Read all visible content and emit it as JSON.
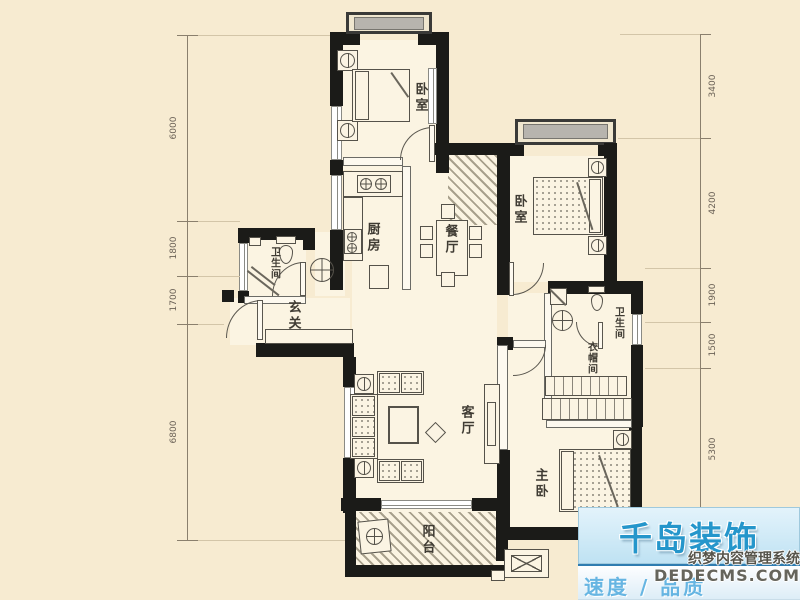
{
  "rooms": [
    {
      "id": "bedroom-1",
      "label": "卧室"
    },
    {
      "id": "bedroom-2",
      "label": "卧室"
    },
    {
      "id": "kitchen",
      "label": "厨房"
    },
    {
      "id": "dining-room",
      "label": "餐厅"
    },
    {
      "id": "bathroom-1",
      "label": "卫生间"
    },
    {
      "id": "foyer",
      "label": "玄关"
    },
    {
      "id": "living-room",
      "label": "客厅"
    },
    {
      "id": "bathroom-2",
      "label": "卫生间"
    },
    {
      "id": "cloakroom",
      "label": "衣帽间"
    },
    {
      "id": "master-bedroom",
      "label": "主卧"
    },
    {
      "id": "balcony",
      "label": "阳台"
    }
  ],
  "dimensions": {
    "left": [
      "6000",
      "1800",
      "1700",
      "6800"
    ],
    "right": [
      "3400",
      "4200",
      "1900",
      "1500",
      "5300"
    ]
  },
  "watermark": {
    "brand": "千岛装饰",
    "tagline": "速度 / 品质",
    "cms_line1": "织梦内容管理系统",
    "cms_line2": "DEDECMS.COM"
  },
  "colors": {
    "background": "#f7ebd1",
    "wall": "#1b1b18",
    "accent_blue": "#2596cb"
  }
}
